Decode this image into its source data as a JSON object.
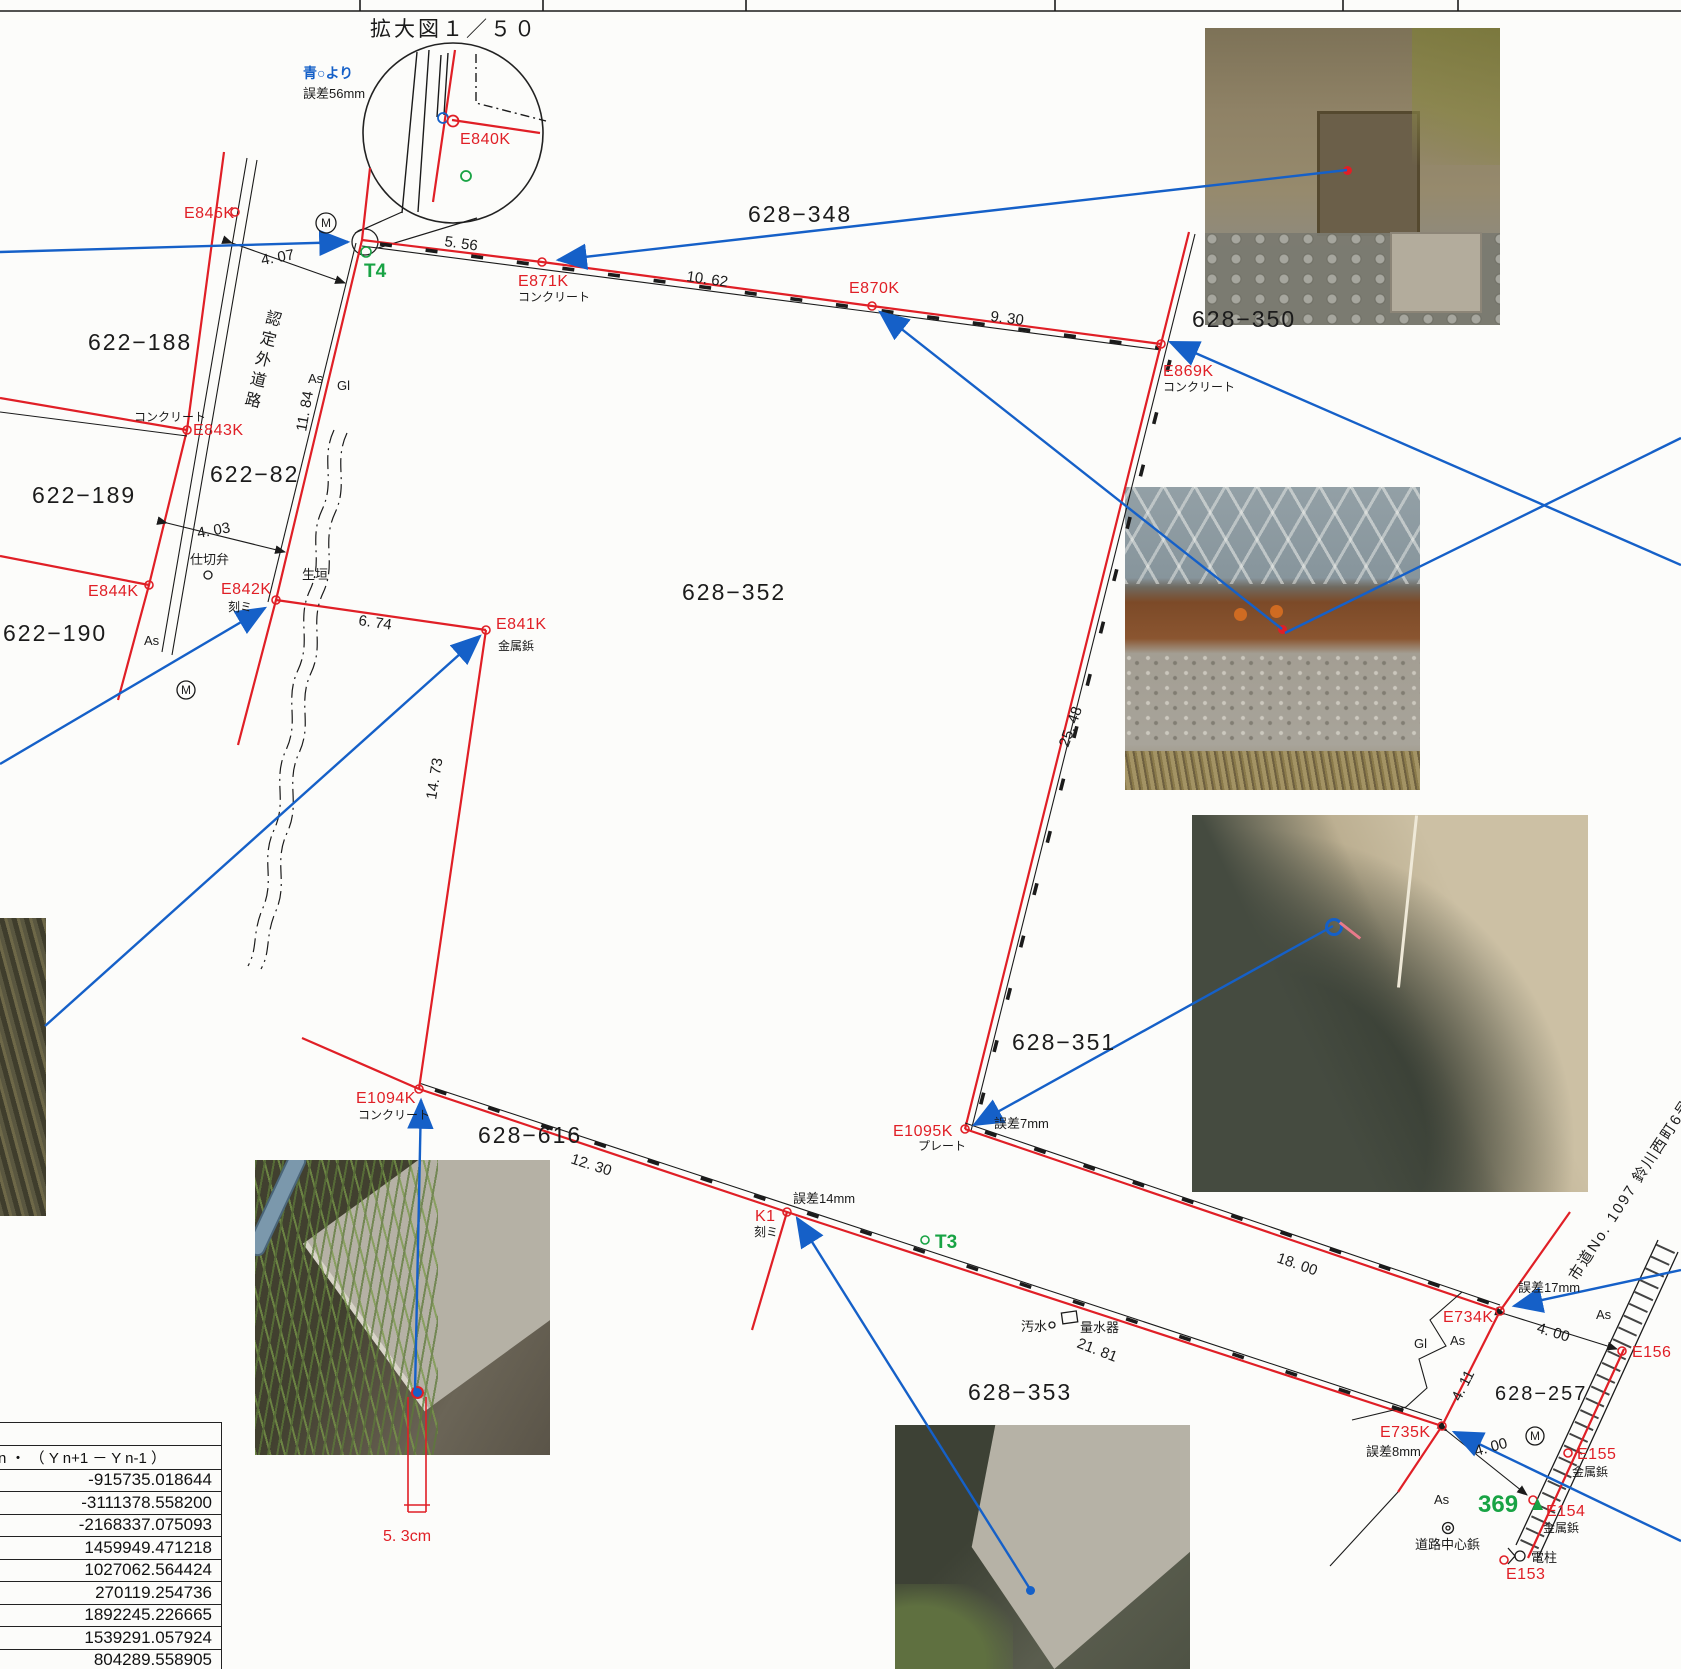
{
  "inset": {
    "title": "拡大図１／５０",
    "from_note": "青○より",
    "error_note": "誤差56mm",
    "point_label": "E840K"
  },
  "stations": {
    "e846k": {
      "name": "E846K"
    },
    "e843k": {
      "name": "E843K",
      "type": "コンクリート"
    },
    "e844k": {
      "name": "E844K"
    },
    "e842k": {
      "name": "E842K",
      "type": "刻ミ"
    },
    "e841k": {
      "name": "E841K",
      "type": "金属鋲"
    },
    "e871k": {
      "name": "E871K",
      "type": "コンクリート"
    },
    "e870k": {
      "name": "E870K"
    },
    "e869k": {
      "name": "E869K",
      "type": "コンクリート"
    },
    "e1094k": {
      "name": "E1094K",
      "type": "コンクリート"
    },
    "e1095k": {
      "name": "E1095K",
      "type": "プレート",
      "error": "誤差7mm"
    },
    "k1": {
      "name": "K1",
      "type": "刻ミ",
      "error": "誤差14mm"
    },
    "e734k": {
      "name": "E734K",
      "error": "誤差17mm"
    },
    "e735k": {
      "name": "E735K",
      "error": "誤差8mm"
    },
    "e156": {
      "name": "E156"
    },
    "e155": {
      "name": "E155",
      "type": "金属鋲"
    },
    "e154": {
      "name": "E154",
      "type": "金属鋲"
    },
    "e153": {
      "name": "E153"
    },
    "t4": {
      "name": "T4"
    },
    "t3": {
      "name": "T3"
    }
  },
  "parcels": {
    "p622_188": "622−188",
    "p622_189": "622−189",
    "p622_190": "622−190",
    "p622_82": "622−82",
    "p628_348": "628−348",
    "p628_350": "628−350",
    "p628_352": "628−352",
    "p628_351": "628−351",
    "p628_617": "628−617",
    "p628_616": "628−616",
    "p628_353": "628−353",
    "p628_257": "628−257",
    "p369": "369"
  },
  "dimensions": {
    "d4_07": "4. 07",
    "d4_03": "4. 03",
    "d11_84": "11. 84",
    "d5_56": "5. 56",
    "d10_62": "10. 62",
    "d9_30": "9. 30",
    "d25_48": "25. 48",
    "d6_74": "6. 74",
    "d14_73": "14. 73",
    "d12_30": "12. 30",
    "d18_00": "18. 00",
    "d21_81": "21. 81",
    "d4_00a": "4. 00",
    "d4_00b": "4. 00",
    "d4_11": "4. 11"
  },
  "annotations": {
    "road": "認定外道路",
    "valve": "仕切弁",
    "hedge": "生垣",
    "as": "As",
    "gl": "Gl",
    "sewer": "汚水",
    "water_meter": "量水器",
    "center_pin": "道路中心鋲",
    "pole": "電柱",
    "road_name": "市道No. 1097 鈴川西町6号線",
    "offset_note": "5. 3cm",
    "m": "M"
  },
  "table": {
    "header": "n ・ （ Y n+1 － Y n-1 ）",
    "values": [
      "-915735.018644",
      "-3111378.558200",
      "-2168337.075093",
      "1459949.471218",
      "1027062.564424",
      "270119.254736",
      "1892245.226665",
      "1539291.057924",
      "804289.558905"
    ]
  },
  "colors": {
    "red": "#e01f26",
    "blue": "#1560c8",
    "green": "#18a344",
    "black": "#1b1b1b"
  }
}
